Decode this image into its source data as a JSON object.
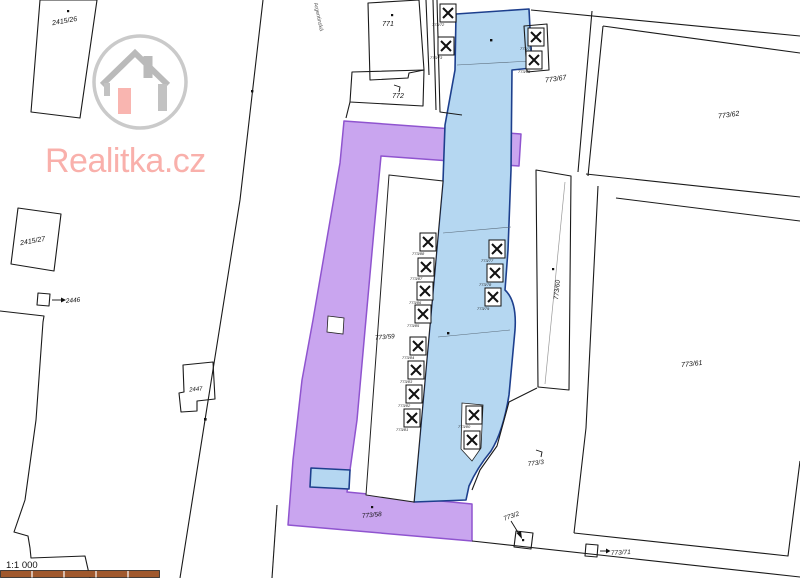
{
  "brand": {
    "name": "Realitka.cz",
    "text_color": "#f8a39d",
    "circle_color": "#bdbdbd",
    "house_color": "#a9a9a9",
    "door_color": "#f8a39d"
  },
  "map": {
    "street_name": "Argentinská",
    "scale_text": "1:1 000",
    "scalebar_color": "#a0592e",
    "colors": {
      "highlight_blue": "#b5d7f1",
      "highlight_blue_border": "#1d3f8d",
      "highlight_purple": "#c9a5ef",
      "highlight_purple_border": "#8f54cf",
      "boundary": "#1a1a1a"
    },
    "parcels": {
      "p2415_26": "2415/26",
      "p2415_27": "2415/27",
      "p2446": "2446",
      "p2447": "2447",
      "p771": "771",
      "p772": "772",
      "p773_67": "773/67",
      "p773_62": "773/62",
      "p773_60": "773/60",
      "p773_61": "773/61",
      "p773_59": "773/59",
      "p773_58": "773/58",
      "p773_3": "773/3",
      "p773_2": "773/2",
      "p773_71": "773/71"
    },
    "garages": [
      "773/72",
      "773/73",
      "773/74",
      "773/75",
      "773/77",
      "773/78",
      "773/79",
      "773/88",
      "773/87",
      "773/86",
      "773/85",
      "773/84",
      "773/83",
      "773/82",
      "773/81",
      "773/80"
    ]
  }
}
